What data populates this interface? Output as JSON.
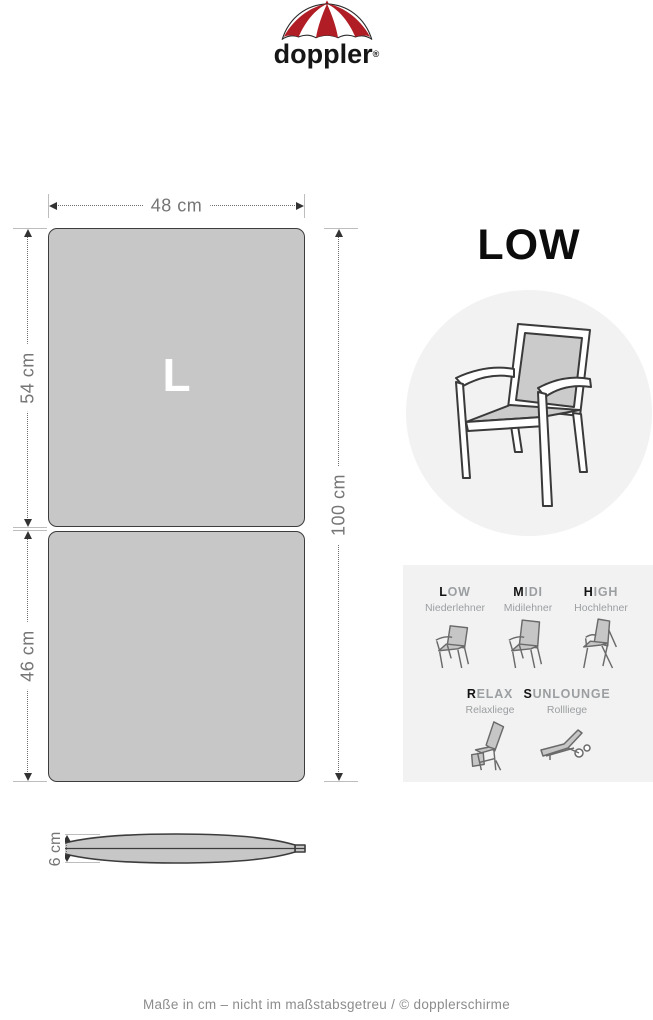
{
  "brand": {
    "wordmark": "doppler",
    "registered": "®",
    "logo_icon": "doppler-umbrella-icon",
    "accent_color": "#b01d24"
  },
  "diagram": {
    "size_label": "L",
    "dim_width": "48 cm",
    "dim_top_section": "54 cm",
    "dim_bottom_section": "46 cm",
    "dim_total_height": "100 cm",
    "dim_thickness": "6 cm",
    "cushion_fill": "#c7c7c7",
    "cushion_outline": "#3c3c3c"
  },
  "product": {
    "title": "LOW",
    "hero_icon": "low-armchair-icon",
    "circle_bg": "#f2f2f2"
  },
  "variants": {
    "panel_bg": "#f2f2f2",
    "row1": [
      {
        "initial": "L",
        "rest": "OW",
        "subtitle": "Niederlehner",
        "icon": "chair-low-icon"
      },
      {
        "initial": "M",
        "rest": "IDI",
        "subtitle": "Midilehner",
        "icon": "chair-midi-icon"
      },
      {
        "initial": "H",
        "rest": "IGH",
        "subtitle": "Hochlehner",
        "icon": "chair-high-icon"
      }
    ],
    "row2": [
      {
        "initial": "R",
        "rest": "ELAX",
        "subtitle": "Relaxliege",
        "icon": "chair-relax-icon"
      },
      {
        "initial": "S",
        "rest": "UNLOUNGE",
        "subtitle": "Rollliege",
        "icon": "sunlounge-icon"
      }
    ]
  },
  "footer": {
    "text": "Maße in cm – nicht im maßstabsgetreu  / © dopplerschirme"
  }
}
